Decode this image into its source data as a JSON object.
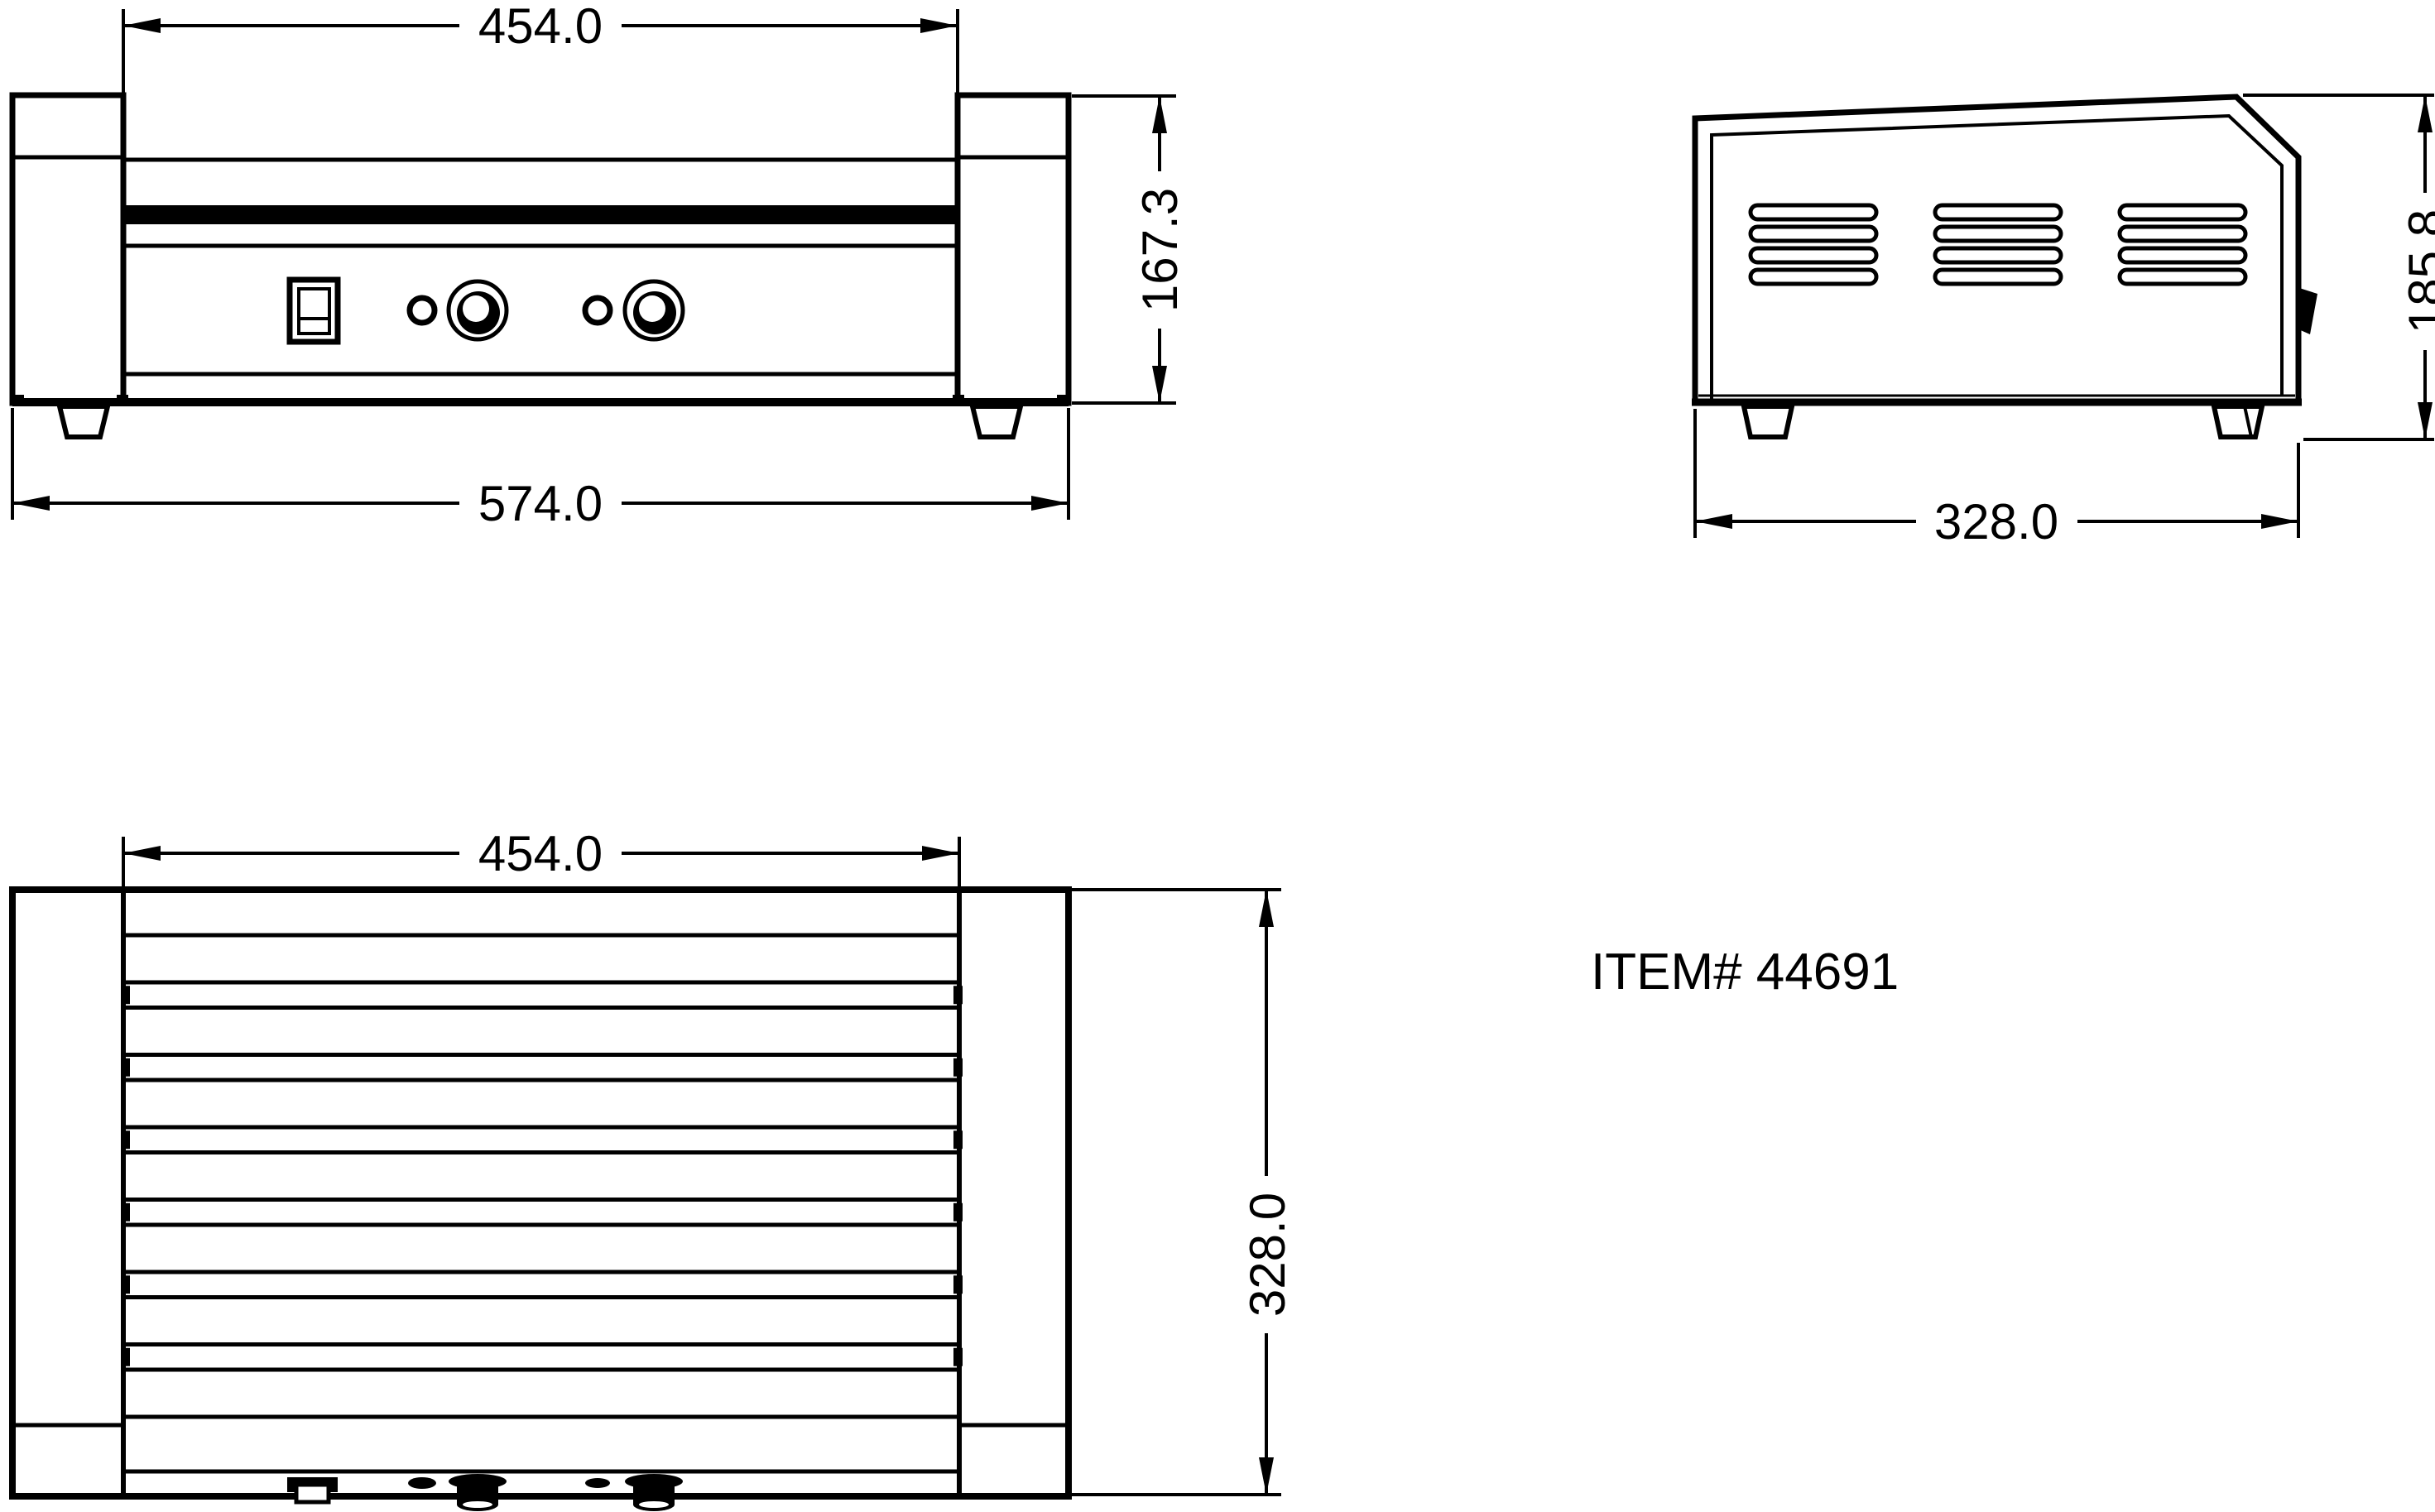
{
  "background": "#ffffff",
  "line_color": "#000000",
  "item_label": "ITEM# 44691",
  "views": {
    "front": {
      "label": "front view",
      "dimensions": {
        "roller_section_width_mm": "454.0",
        "overall_width_mm": "574.0",
        "body_height_mm": "167.3"
      },
      "controls": {
        "power_switch": 1,
        "indicator_lights": 2,
        "knobs": 2
      }
    },
    "side": {
      "label": "side view",
      "dimensions": {
        "overall_depth_mm": "328.0",
        "overall_height_mm": "185.8"
      },
      "vent_groups": 3,
      "vent_rows_per_group": 4
    },
    "top": {
      "label": "top view",
      "dimensions": {
        "roller_section_width_mm": "454.0",
        "overall_depth_mm": "328.0"
      },
      "roller_count": 7
    }
  }
}
